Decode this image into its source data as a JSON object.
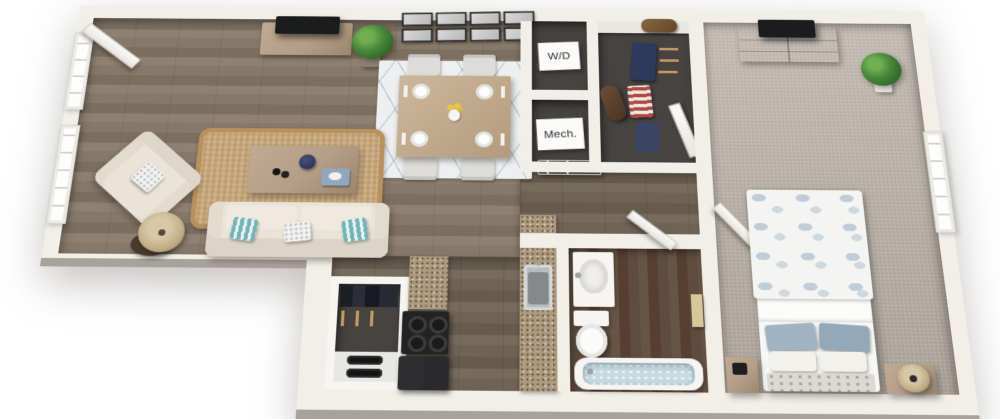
{
  "image_type": "3d-rendered-apartment-floor-plan",
  "background": "#ffffff",
  "labels": {
    "washer_dryer": "W/D",
    "mechanical": "Mech."
  },
  "palette": {
    "bg": "#ffffff",
    "wall": "#f2efe9",
    "wallface": "#a8a29a",
    "wood": "#867868",
    "woodark": "#6e6254",
    "bathwood": "#5d4b3d",
    "carpet": "#b9b1a8",
    "darkfloor": "#474341",
    "granite": "#ad9a7f",
    "jute": "#c9a97c",
    "rugwhite": "#edeff0",
    "cream": "#e9e3d8",
    "teal": "#74b3b7",
    "taupe": "#b59e88",
    "tvblack": "#1b1c1e",
    "plant": "#47873b",
    "water": "#c8dbe1",
    "bedblue": "#a0b4c3",
    "doorwhite": "#f6f5f2",
    "textdark": "#2e2e2e"
  },
  "rooms": [
    {
      "id": "living-room",
      "floor": "hardwood",
      "items": [
        "tv-console",
        "tv",
        "potted-plant",
        "gallery-of-8-frames",
        "sofa",
        "teal-striped-pillows",
        "white-pillow",
        "coffee-table",
        "navy-vase",
        "binoculars",
        "blue-book",
        "jute-rug",
        "armchair",
        "armchair-pillow",
        "floor-lamp",
        "left-windows",
        "balcony-door"
      ]
    },
    {
      "id": "dining-area",
      "floor": "hardwood",
      "items": [
        "dining-table",
        "four-chairs",
        "four-place-settings",
        "yellow-flower-centerpiece",
        "geometric-area-rug"
      ]
    },
    {
      "id": "laundry-closet",
      "label": "W/D"
    },
    {
      "id": "mechanical-closet",
      "label": "Mech."
    },
    {
      "id": "walk-in-closet",
      "items": [
        "shelf",
        "duffel-bag",
        "hanging-clothes",
        "garment-bag",
        "closet-door"
      ]
    },
    {
      "id": "entry-hall",
      "items": [
        "front-door"
      ]
    },
    {
      "id": "coat-closet",
      "items": [
        "hanging-coats",
        "two-pairs-of-shoes"
      ]
    },
    {
      "id": "kitchen",
      "floor": "hardwood",
      "items": [
        "granite-counter-left",
        "black-range",
        "black-refrigerator",
        "granite-counter-right",
        "stainless-sink"
      ]
    },
    {
      "id": "bathroom",
      "floor": "dark-hardwood",
      "items": [
        "vanity-sink",
        "toilet",
        "bathtub-with-water",
        "towel-bar",
        "bathroom-door"
      ]
    },
    {
      "id": "bedroom",
      "floor": "carpet",
      "items": [
        "dresser",
        "tv",
        "potted-plant",
        "bed-with-floral-duvet",
        "blue-pillows",
        "white-pillows",
        "nightstand-left",
        "nightstand-right",
        "round-table-lamp",
        "right-window",
        "bedroom-door"
      ]
    }
  ]
}
